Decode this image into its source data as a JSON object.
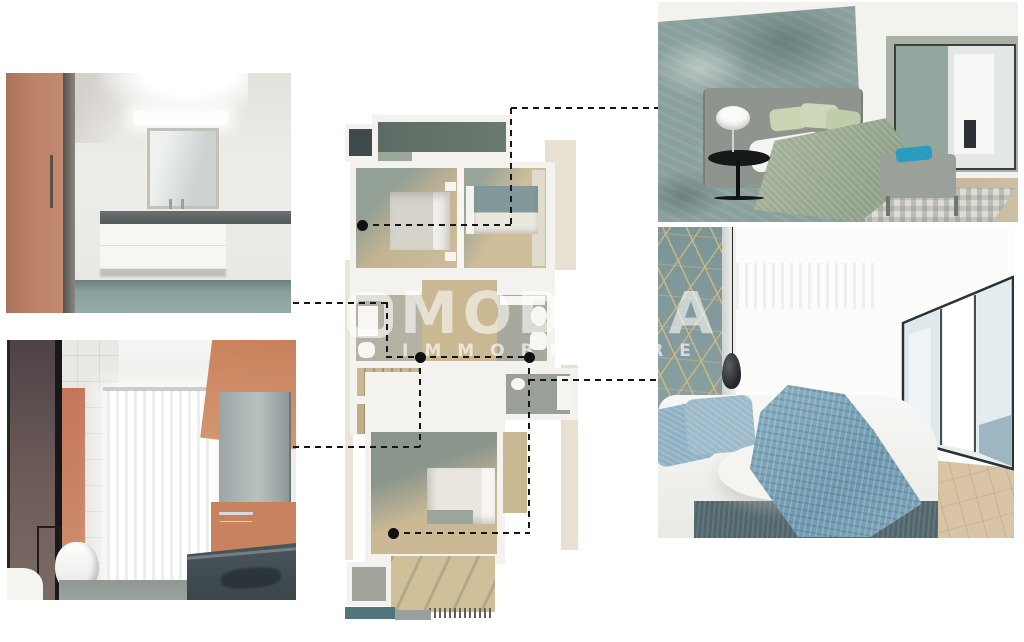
{
  "watermark": {
    "title": "MODENA",
    "subtitle": "IMMOBILIARE",
    "logo": "rounded-square-logo",
    "color": "#ffffff"
  },
  "palette": {
    "terracotta_door": "#bd8166",
    "orange_wall": "#c97f58",
    "teal_floor": "#87a09c",
    "dark_counter": "#596063",
    "stone_wall": "#8aa09c",
    "sage_duvet": "#a3b098",
    "blue_throw": "#7fa6ba",
    "geo_wall": "#7e989b",
    "gold_line": "#d0b982",
    "plan_wood": "#cbb995",
    "plan_terrace": "#5c6c64",
    "plan_balcony_teal": "#50747c",
    "connector": "#161616"
  },
  "photos": [
    {
      "id": "bathroom-vanity",
      "subject": "bathroom with terracotta door, mirror and white floating vanity"
    },
    {
      "id": "bathroom-shower",
      "subject": "bathroom with dark glass shower, bidet, window and double dark vanity"
    },
    {
      "id": "bedroom-green",
      "subject": "bedroom with stone accent wall, grey headboard and sage green bed"
    },
    {
      "id": "bedroom-blue",
      "subject": "bedroom with geometric accent wall, blue throw and mirrored wardrobe"
    }
  ],
  "plan": {
    "dots": [
      {
        "x": 362,
        "y": 225
      },
      {
        "x": 420,
        "y": 357
      },
      {
        "x": 529,
        "y": 357
      },
      {
        "x": 393,
        "y": 533
      }
    ],
    "segments": [
      {
        "dir": "h",
        "x": 293,
        "y": 302,
        "len": 94
      },
      {
        "dir": "v",
        "x": 386,
        "y": 302,
        "len": 56
      },
      {
        "dir": "h",
        "x": 386,
        "y": 356,
        "len": 143
      },
      {
        "dir": "h",
        "x": 293,
        "y": 446,
        "len": 128
      },
      {
        "dir": "v",
        "x": 419,
        "y": 357,
        "len": 90
      },
      {
        "dir": "h",
        "x": 362,
        "y": 224,
        "len": 150
      },
      {
        "dir": "v",
        "x": 510,
        "y": 108,
        "len": 117
      },
      {
        "dir": "h",
        "x": 511,
        "y": 107,
        "len": 147
      },
      {
        "dir": "h",
        "x": 393,
        "y": 532,
        "len": 137
      },
      {
        "dir": "v",
        "x": 528,
        "y": 357,
        "len": 176
      },
      {
        "dir": "h",
        "x": 529,
        "y": 379,
        "len": 129
      }
    ]
  }
}
